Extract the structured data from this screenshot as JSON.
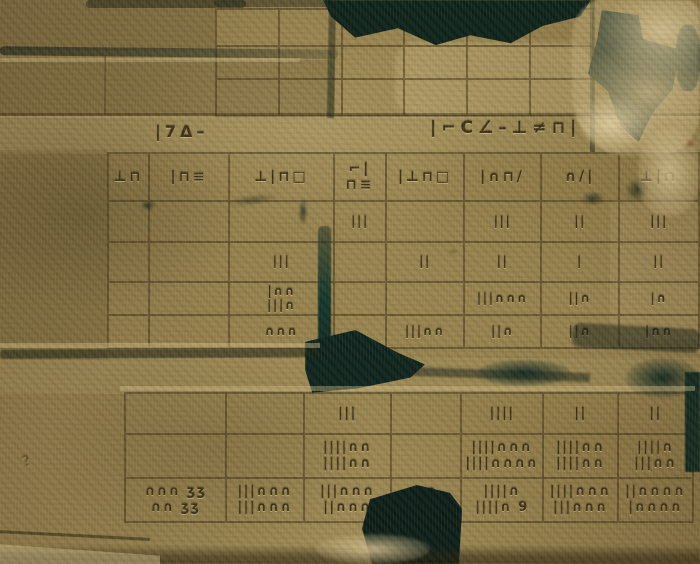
{
  "scene": {
    "type": "stone-relief-photo",
    "colors": {
      "stone_mid": "#8d7947",
      "stone_dark": "#6d5a33",
      "stone_light": "#c9b586",
      "break_shadow": "#0c2119",
      "carved_mark": "#3c2f16"
    }
  },
  "inscriptions": {
    "left": "|7Δ–",
    "right": "|⌐C∠–⊥≠⊓|",
    "scratch": "?"
  },
  "main_table": {
    "header_cells": [
      "⊥⊓",
      "|⊓≡",
      "⊥|⊓□",
      "⌐|⊓≡",
      "|⊥⊓□",
      "|∩⊓/",
      "∩/|",
      "⊥|⊓"
    ],
    "rows": [
      {
        "cells": [
          "",
          "",
          "",
          "|||",
          "",
          "|||",
          "||",
          "|||"
        ]
      },
      {
        "cells": [
          "",
          "",
          "|||",
          "",
          "||",
          "||",
          "|",
          "||"
        ]
      },
      {
        "cells": [
          "",
          "",
          "|∩∩\n|||∩",
          "",
          "",
          "|||∩∩∩",
          "||∩",
          "|∩"
        ]
      },
      {
        "cells": [
          "",
          "",
          "∩∩∩",
          "",
          "|||∩∩",
          "||∩",
          "||∩",
          "|∩∩"
        ]
      }
    ]
  },
  "bottom_table": {
    "rows": [
      {
        "cells": [
          "",
          "",
          "|||",
          "",
          "||||",
          "||",
          "||"
        ]
      },
      {
        "cells": [
          "",
          "",
          "||||∩∩\n||||∩∩",
          "",
          "||||∩∩∩\n||||∩∩∩∩",
          "||||∩∩\n||||∩∩",
          "||||∩\n|||∩∩"
        ]
      },
      {
        "cells": [
          "∩∩∩ ʒʒ\n∩∩ ʒʒ",
          "|||∩∩∩\n|||∩∩∩",
          "|||∩∩∩\n||∩∩∩",
          "∩∩\n|∩∩",
          "||||∩\n||||∩ 9",
          "||||∩∩∩\n|||∩∩∩",
          "||∩∩∩∩\n|∩∩∩∩"
        ]
      }
    ]
  }
}
